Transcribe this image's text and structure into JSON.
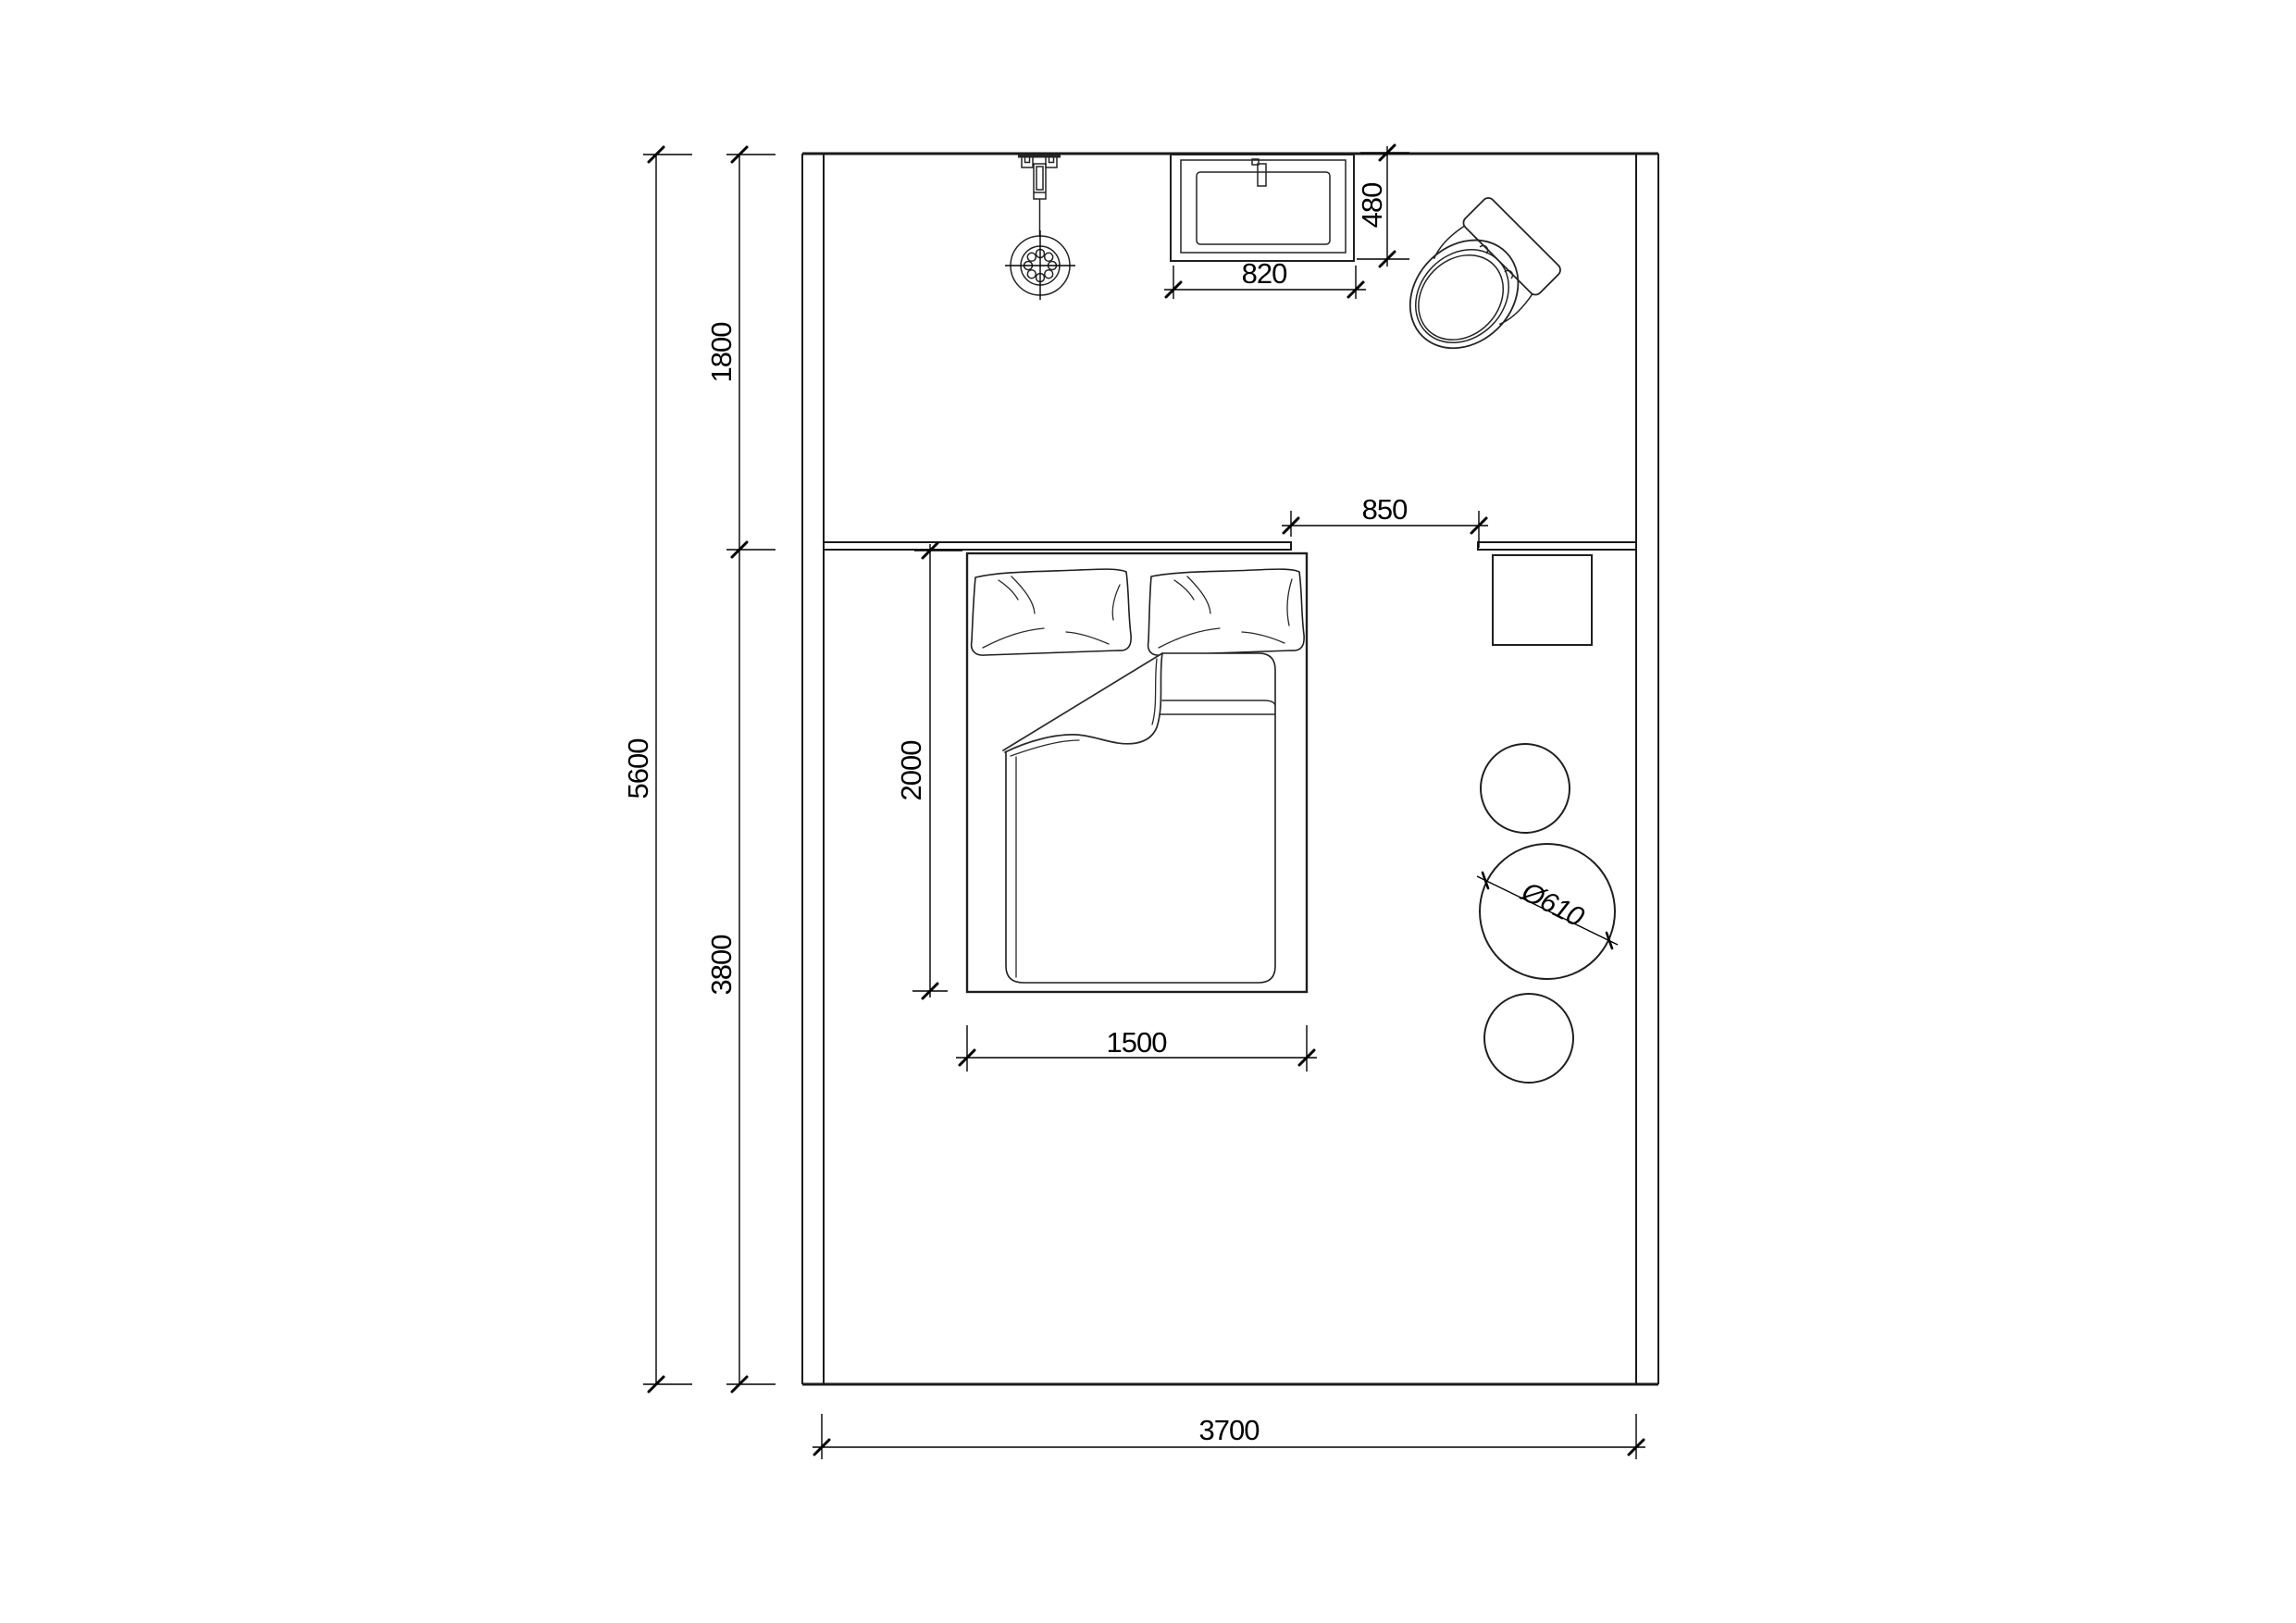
{
  "drawing": {
    "type": "architectural-floor-plan",
    "room": "bedroom-with-bath-area",
    "line_color": "#1a1a1a",
    "background": "#ffffff"
  },
  "dimensions": {
    "overall_height": "5600",
    "top_section": "1800",
    "bottom_section": "3800",
    "overall_width": "3700",
    "basin_width": "820",
    "basin_depth": "480",
    "clearance": "850",
    "bed_length": "2000",
    "bed_width": "1500",
    "table_diameter": "Ø610"
  },
  "fixtures": [
    "shower-head",
    "wash-basin",
    "toilet",
    "headboard-panel",
    "double-bed",
    "nightstand",
    "wall-shelf",
    "round-table",
    "stools"
  ]
}
